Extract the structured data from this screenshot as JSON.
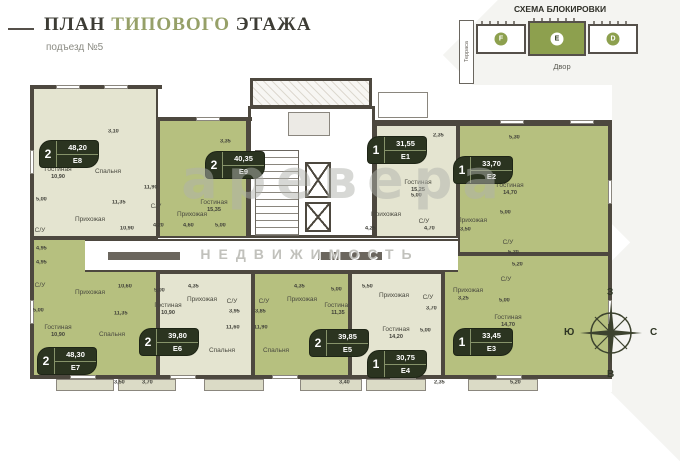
{
  "header": {
    "title": {
      "p1": "ПЛАН",
      "p2": "ТИПОВОГО",
      "p3": "ЭТАЖА"
    },
    "subtitle": "подъезд №5"
  },
  "schema": {
    "title": "СХЕМА БЛОКИРОВКИ",
    "terrace": "Терраса",
    "yard": "Двор",
    "blocks": [
      {
        "label": "F",
        "active": false
      },
      {
        "label": "E",
        "active": true
      },
      {
        "label": "D",
        "active": false
      }
    ],
    "active_color": "#8da04e"
  },
  "watermark": {
    "brand": "аревера",
    "caption": "НЕДВИЖИМОСТЬ"
  },
  "compass": {
    "top": "З",
    "right": "С",
    "bottom": "В",
    "left": "Ю"
  },
  "plan": {
    "colors": {
      "wall": "#4d483f",
      "apartment": "#e4e4d0",
      "highlight": "#b6c07f",
      "badge": "#2b3420"
    },
    "apartments": [
      {
        "code": "E8",
        "rooms_count": "2",
        "area": "48,20",
        "highlighted": false,
        "rooms": [
          {
            "n": "Гостиная",
            "a": "10,90"
          },
          {
            "n": "Спальня"
          },
          {
            "n": "Прихожая"
          },
          {
            "n": "С/У"
          }
        ]
      },
      {
        "code": "E9",
        "rooms_count": "2",
        "area": "40,35",
        "highlighted": true,
        "rooms": [
          {
            "n": "Гостиная",
            "a": "15,35"
          },
          {
            "n": "Прихожая"
          },
          {
            "n": "С/У"
          }
        ]
      },
      {
        "code": "E1",
        "rooms_count": "1",
        "area": "31,55",
        "highlighted": false,
        "rooms": [
          {
            "n": "Гостиная",
            "a": "15,25"
          },
          {
            "n": "Прихожая"
          },
          {
            "n": "С/У"
          }
        ]
      },
      {
        "code": "E2",
        "rooms_count": "1",
        "area": "33,70",
        "highlighted": true,
        "rooms": [
          {
            "n": "Гостиная",
            "a": "14,70"
          },
          {
            "n": "Прихожая"
          },
          {
            "n": "С/У"
          }
        ]
      },
      {
        "code": "E7",
        "rooms_count": "2",
        "area": "48,30",
        "highlighted": true,
        "rooms": [
          {
            "n": "Гостиная",
            "a": "10,90"
          },
          {
            "n": "Спальня"
          },
          {
            "n": "Прихожая"
          },
          {
            "n": "С/У"
          }
        ]
      },
      {
        "code": "E6",
        "rooms_count": "2",
        "area": "39,80",
        "highlighted": false,
        "rooms": [
          {
            "n": "Гостиная",
            "a": "10,90"
          },
          {
            "n": "Спальня"
          },
          {
            "n": "Прихожая"
          },
          {
            "n": "С/У"
          }
        ]
      },
      {
        "code": "E5",
        "rooms_count": "2",
        "area": "39,85",
        "highlighted": true,
        "rooms": [
          {
            "n": "Гостиная",
            "a": "11,35"
          },
          {
            "n": "Спальня"
          },
          {
            "n": "Прихожая"
          },
          {
            "n": "С/У"
          }
        ]
      },
      {
        "code": "E4",
        "rooms_count": "1",
        "area": "30,75",
        "highlighted": false,
        "rooms": [
          {
            "n": "Гостиная",
            "a": "14,20"
          },
          {
            "n": "Прихожая"
          },
          {
            "n": "С/У"
          }
        ]
      },
      {
        "code": "E3",
        "rooms_count": "1",
        "area": "33,45",
        "highlighted": true,
        "rooms": [
          {
            "n": "Гостиная",
            "a": "14,70"
          },
          {
            "n": "Прихожая"
          },
          {
            "n": "С/У"
          }
        ]
      }
    ],
    "dims": [
      "3,10",
      "5,00",
      "11,35",
      "10,90",
      "4,95",
      "4,95",
      "11,90",
      "3,35",
      "4,20",
      "4,60",
      "5,00",
      "2,35",
      "5,00",
      "4,25",
      "4,70",
      "5,30",
      "5,00",
      "3,50",
      "5,20",
      "5,00",
      "10,60",
      "11,35",
      "3,50",
      "3,70",
      "5,00",
      "4,35",
      "3,95",
      "11,60",
      "3,85",
      "4,35",
      "11,90",
      "5,00",
      "5,50",
      "3,70",
      "5,00",
      "3,40",
      "2,35",
      "3,25",
      "5,20",
      "5,00",
      "5,20"
    ]
  }
}
